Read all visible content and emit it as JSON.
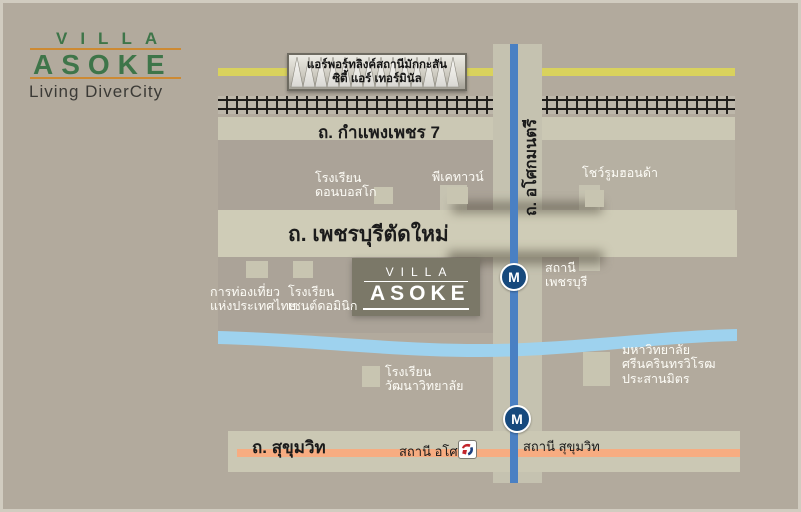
{
  "logo": {
    "line1": "VILLA",
    "line2": "ASOKE",
    "tagline": "Living DiverCity"
  },
  "airport_link_station": {
    "line1": "แอร์พอร์ทลิงค์สถานีมักกะสัน",
    "line2": "ซิตี้ แอร์ เทอร์มินัล"
  },
  "roads": {
    "kamphaeng_phet7": "ถ. กำแพงเพชร 7",
    "phetchaburi_new": "ถ. เพชรบุรีตัดใหม่",
    "asoke_montri": "ถ. อโศกมนตรี",
    "sukhumvit": "ถ. สุขุมวิท"
  },
  "project": {
    "line1": "VILLA",
    "line2": "ASOKE"
  },
  "stations": {
    "mrt_phetchaburi": {
      "symbol": "M",
      "line1": "สถานี",
      "line2": "เพชรบุรี"
    },
    "mrt_sukhumvit": {
      "symbol": "M",
      "label": "สถานี สุขุมวิท"
    },
    "bts_asok": {
      "label": "สถานี อโศก"
    }
  },
  "landmarks": {
    "don_bosco": {
      "line1": "โรงเรียน",
      "line2": "ดอนบอสโก"
    },
    "pk_tower": {
      "line1": "พีเคทาวน์"
    },
    "honda_showroom": {
      "line1": "โชว์รูมฮอนด้า"
    },
    "tourism_authority": {
      "line1": "การท่องเที่ยว",
      "line2": "แห่งประเทศไทย"
    },
    "st_dominic": {
      "line1": "โรงเรียน",
      "line2": "เซนต์ดอมินิก"
    },
    "srinakharinwirot_university": {
      "line1": "มหาวิทยาลัย",
      "line2": "ศรีนครินทรวิโรฒ",
      "line3": "ประสานมิตร"
    },
    "wattana_academy": {
      "line1": "โรงเรียน",
      "line2": "วัฒนาวิทยาลัย"
    }
  },
  "colors": {
    "background": "#b2aa9d",
    "road_band": "#cbc8b4",
    "airport_rail_yellow": "#d9d25d",
    "mrt_line_blue": "#4a80c3",
    "mrt_badge_navy": "#16497d",
    "canal_blue": "#9ed2ee",
    "sukhumvit_orange": "#f7ac81",
    "project_box": "#7b7868",
    "logo_green": "#3e7549",
    "logo_orange": "#cd8a33"
  }
}
